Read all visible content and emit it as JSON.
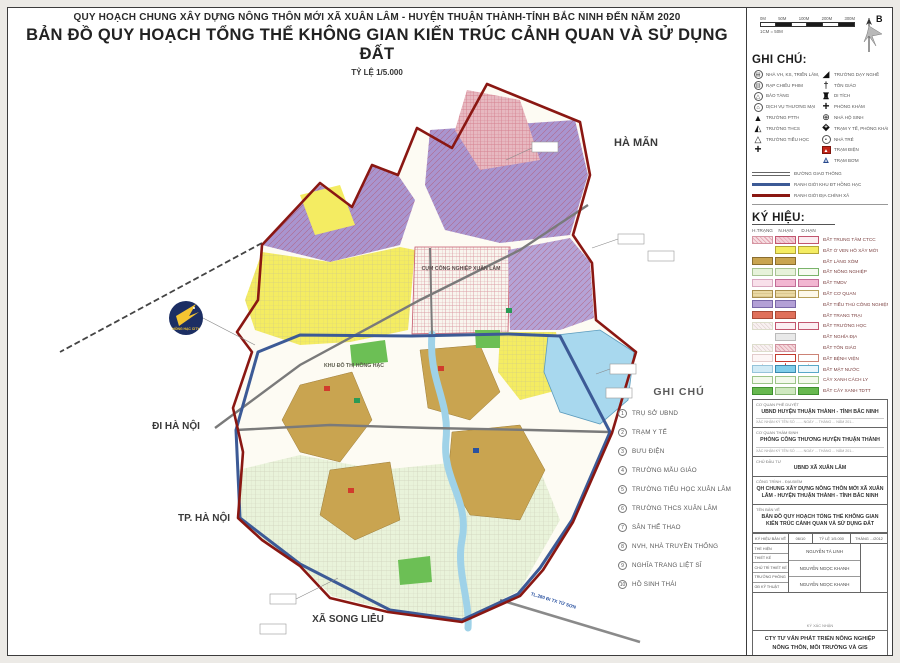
{
  "header": {
    "line1": "QUY HOẠCH CHUNG XÂY DỰNG NÔNG THÔN MỚI XÃ XUÂN LÂM  - HUYỆN THUẬN THÀNH-TỈNH BẮC NINH ĐẾN NĂM 2020",
    "line2": "BẢN ĐỒ QUY HOẠCH TỔNG THỂ KHÔNG GIAN KIẾN TRÚC CẢNH QUAN VÀ SỬ DỤNG ĐẤT",
    "scale": "TỶ LỆ 1/5.000"
  },
  "map": {
    "labels": {
      "north_area": "HÀ MÃN",
      "west_road": "ĐI HÀ NỘI",
      "southwest_city": "TP. HÀ NỘI",
      "south_commune": "XÃ SONG LIỄU",
      "industrial_cluster": "CỤM CÔNG NGHIỆP XUÂN LÂM",
      "urban_area": "KHU ĐÔ THỊ HỒNG HẠC",
      "southeast_road": "TL.280 ĐI TX TỪ SƠN",
      "logo_text": "HỒNG HẠC CITY"
    },
    "notes": {
      "title": "GHI CHÚ",
      "items": [
        "TRỤ SỞ UBND",
        "TRẠM Y TẾ",
        "BƯU ĐIỆN",
        "TRƯỜNG MẪU GIÁO",
        "TRƯỜNG TIỂU HỌC XUÂN LÂM",
        "TRƯỜNG THCS XUÂN LÂM",
        "SÂN THỂ THAO",
        "NVH, NHÀ TRUYỀN THỐNG",
        "NGHĨA TRANG LIỆT SĨ",
        "HỒ SINH THÁI"
      ]
    }
  },
  "sidebar": {
    "scalebar": {
      "labels": [
        "0M",
        "50M",
        "100M",
        "200M",
        "300M"
      ],
      "ratio": "1CM = 50M"
    },
    "compass": "B",
    "legend": {
      "title": "GHI CHÚ:",
      "left": [
        {
          "icon": "theater-icon",
          "label": "NHÀ VH, KS, TRIỂN LÃM, NHÀ HÁT"
        },
        {
          "icon": "cinema-icon",
          "label": "RẠP CHIẾU PHIM"
        },
        {
          "icon": "museum-icon",
          "label": "BẢO TÀNG"
        },
        {
          "icon": "commerce-icon",
          "label": "DỊCH VỤ THƯƠNG MẠI"
        },
        {
          "icon": "highschool-icon",
          "label": "TRƯỜNG PTTH"
        },
        {
          "icon": "secondary-school-icon",
          "label": "TRƯỜNG THCS"
        },
        {
          "icon": "primary-school-icon",
          "label": "TRƯỜNG TIỂU HỌC"
        },
        {
          "icon": "plus-icon",
          "label": ""
        }
      ],
      "right": [
        {
          "icon": "vocational-icon",
          "label": "TRƯỜNG DẠY NGHỀ"
        },
        {
          "icon": "religion-icon",
          "label": "TÔN GIÁO"
        },
        {
          "icon": "relic-icon",
          "label": "DI TÍCH"
        },
        {
          "icon": "clinic-icon",
          "label": "PHÒNG KHÁM"
        },
        {
          "icon": "maternity-icon",
          "label": "NHÀ HỘ SINH"
        },
        {
          "icon": "health-station-icon",
          "label": "TRẠM Y TẾ, PHÒNG KHÁM ĐK"
        },
        {
          "icon": "kindergarten-icon",
          "label": "NHÀ TRẺ"
        },
        {
          "icon": "power-station-icon",
          "label": "TRẠM ĐIỆN"
        },
        {
          "icon": "pump-station-icon",
          "label": "TRẠM BƠM"
        }
      ],
      "lines": [
        {
          "style": "road",
          "color": "#666666",
          "label": "ĐƯỜNG GIAO THÔNG"
        },
        {
          "style": "solid",
          "color": "#3c5a96",
          "label": "RANH GIỚI KHU ĐT HỒNG HẠC"
        },
        {
          "style": "solid",
          "color": "#8a1712",
          "label": "RANH GIỚI ĐỊA CHÍNH XÃ"
        }
      ]
    },
    "symbols": {
      "title": "KÝ HIỆU:",
      "columns": [
        "H.TRẠNG",
        "N.HẠN",
        "D.HẠN"
      ],
      "rows": [
        {
          "label": "ĐẤT TRUNG TÂM CTCC",
          "cells": [
            "hatch-pink",
            "pink-border",
            "pink-outline"
          ]
        },
        {
          "label": "ĐẤT Ở VEN HỒ XÂY MỚI",
          "cells": [
            null,
            "yellow",
            "yellow"
          ]
        },
        {
          "label": "ĐẤT LÀNG XÓM",
          "cells": [
            "tan",
            "tan",
            null
          ]
        },
        {
          "label": "ĐẤT NÔNG NGHIỆP",
          "cells": [
            "green-pale",
            "green-pale",
            "green-outline"
          ]
        },
        {
          "label": "ĐẤT TMDV",
          "cells": [
            "pink-pale",
            "pink",
            "pink"
          ]
        },
        {
          "label": "ĐẤT CƠ QUAN",
          "cells": [
            "tan-hatch",
            "tan-hatch",
            "tan-outline"
          ]
        },
        {
          "label": "ĐẤT TIỂU THỦ CÔNG NGHIỆP",
          "cells": [
            "purple",
            "purple",
            null
          ]
        },
        {
          "label": "ĐẤT TRANG TRẠI",
          "cells": [
            "salmon",
            "salmon",
            null
          ]
        },
        {
          "label": "ĐẤT TRƯỜNG HỌC",
          "cells": [
            "hatch-faint",
            "pink-outline",
            "pink-outline"
          ]
        },
        {
          "label": "ĐẤT NGHĨA ĐỊA",
          "cells": [
            null,
            "gray",
            null
          ]
        },
        {
          "label": "ĐẤT TÔN GIÁO",
          "cells": [
            "hatch-faint",
            "pink-hatch",
            null
          ]
        },
        {
          "label": "ĐẤT BỆNH VIỆN",
          "cells": [
            "cross-faint",
            "cross-red",
            "cross-outline"
          ]
        },
        {
          "label": "ĐẤT MẶT NƯỚC",
          "cells": [
            "blue-pale",
            "blue",
            "blue-outline"
          ]
        },
        {
          "label": "CÂY XANH CÁCH LY",
          "cells": [
            "tree",
            "tree",
            "tree"
          ]
        },
        {
          "label": "ĐẤT CÂY XANH TDTT",
          "cells": [
            "green",
            "green-pale2",
            "green"
          ]
        }
      ]
    },
    "titleblock": {
      "boxes": [
        {
          "label": "CƠ QUAN PHÊ DUYỆT",
          "value": "UBND HUYỆN THUẬN THÀNH - TỈNH BẮC NINH",
          "note": "XÁC NHẬN KÝ TÊN SỐ ....... NGÀY ... THÁNG ... NĂM 201..."
        },
        {
          "label": "CƠ QUAN THẨM ĐỊNH",
          "value": "PHÒNG CÔNG THƯƠNG HUYỆN THUẬN THÀNH",
          "note": "XÁC NHẬN KÝ TÊN SỐ ....... NGÀY ... THÁNG ... NĂM 201..."
        },
        {
          "label": "CHỦ ĐẦU TƯ",
          "value": "UBND XÃ XUÂN LÂM",
          "note": ""
        },
        {
          "label": "CÔNG TRÌNH - ĐỊA ĐIỂM",
          "value": "QH CHUNG XÂY DỰNG NÔNG THÔN MỚI XÃ XUÂN LÂM - HUYỆN THUẬN THÀNH - TỈNH BẮC NINH",
          "note": ""
        },
        {
          "label": "TÊN BẢN VẼ",
          "value": "BẢN ĐỒ QUY HOẠCH TỔNG THỂ KHÔNG GIAN KIẾN TRÚC CẢNH QUAN VÀ SỬ DỤNG ĐẤT",
          "note": ""
        }
      ],
      "table": {
        "h1": "KÝ HIỆU BẢN VẼ",
        "h2": "06/10",
        "h3": "TỶ LỆ 1/5.000",
        "h4": "THÁNG .../2012",
        "roles": [
          "THỂ HIỆN",
          "THIẾT KẾ",
          "CHỦ TRÌ THIẾT KẾ",
          "TRƯỞNG PHÒNG",
          "GĐ KỸ THUẬT"
        ],
        "names": [
          "NGUYỄN TÁ LINH",
          "NGUYỄN NGỌC KHANH",
          "NGUYỄN NGỌC KHANH"
        ],
        "stamp": "KÝ XÁC NHẬN"
      },
      "company": "CTY TƯ VẤN PHÁT TRIỂN NÔNG NGHIỆP NÔNG THÔN, MÔI TRƯỜNG VÀ GIS"
    },
    "colors": {
      "boundary_commune": "#8a1712",
      "boundary_urban": "#3c5a96",
      "residential_yellow": "#f4ec62",
      "village_tan": "#c9a450",
      "industry_purple": "#a995cf",
      "water_blue": "#a8d8ee",
      "agriculture_green": "#e9f3da"
    }
  }
}
